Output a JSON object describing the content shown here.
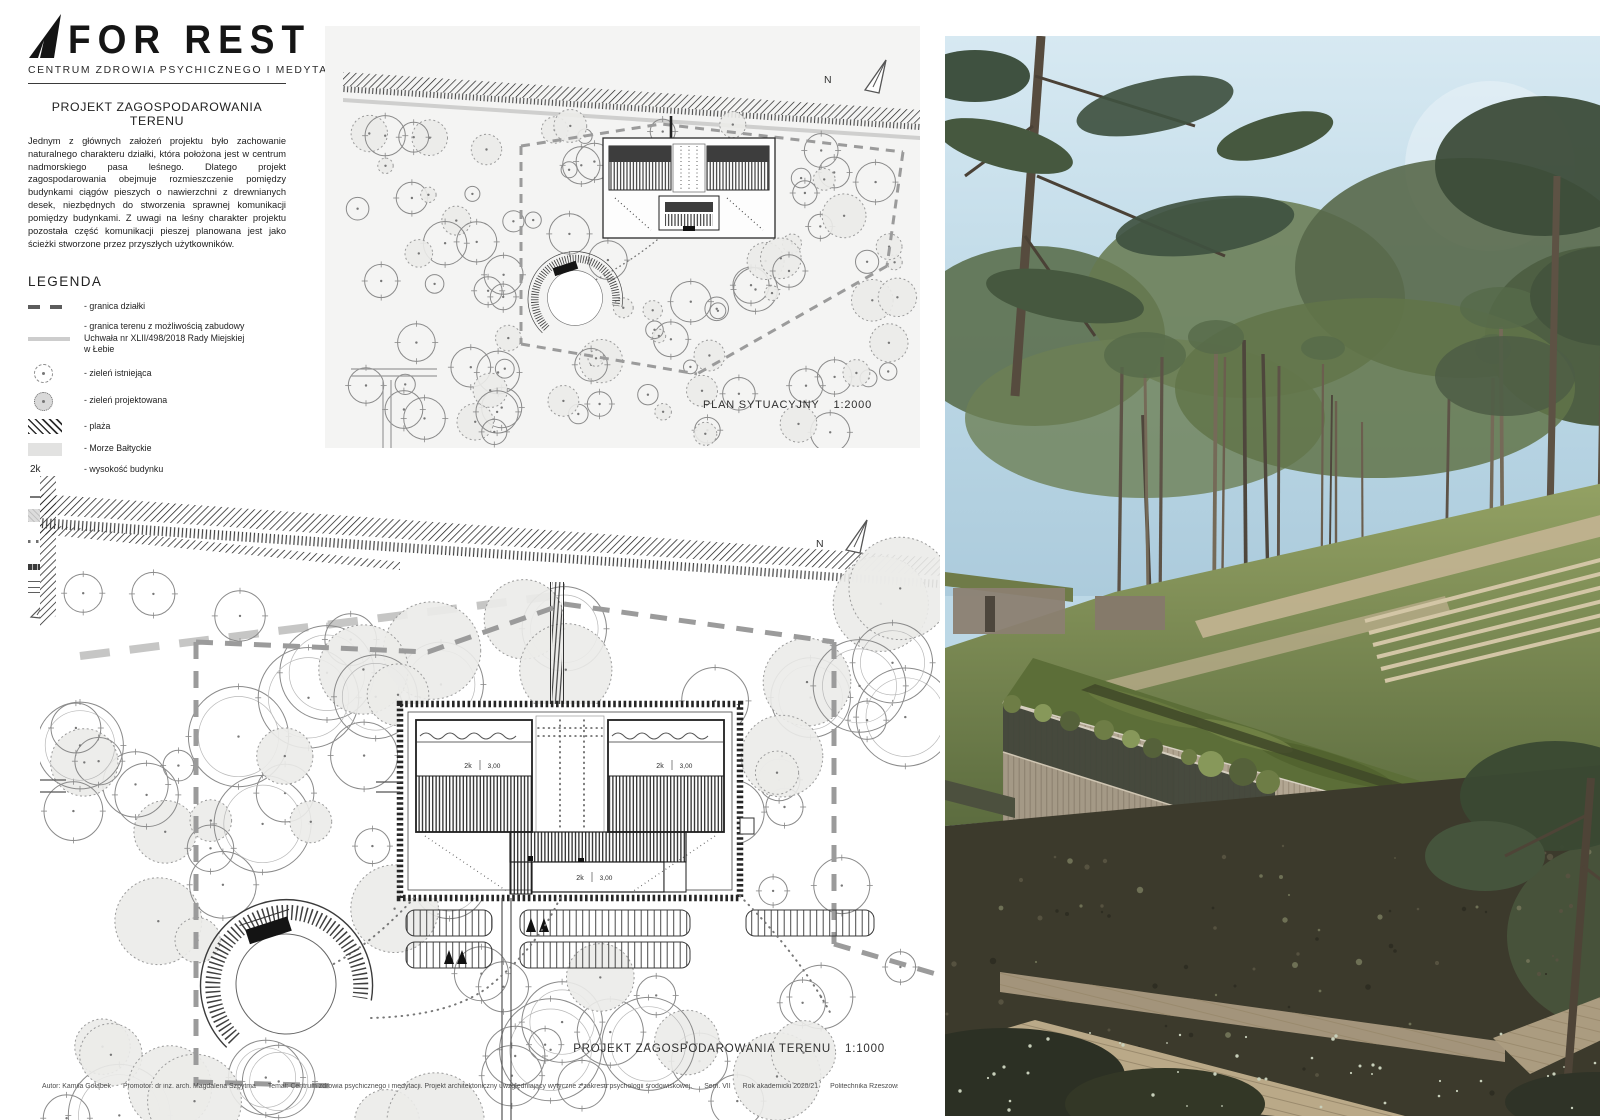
{
  "board": {
    "logo": {
      "title": "FOR REST",
      "subtitle": "CENTRUM ZDROWIA PSYCHICZNEGO I MEDYTACJI"
    },
    "intro": {
      "heading": "PROJEKT ZAGOSPODAROWANIA TERENU",
      "body": "Jednym z głównych założeń projektu było zachowanie naturalnego charakteru działki, która położona jest w centrum nadmorskiego pasa leśnego. Dlatego projekt zagospodarowania obejmuje rozmieszczenie pomiędzy budynkami ciągów pieszych o nawierzchni z drewnianych desek, niezbędnych do stworzenia sprawnej komunikacji pomiędzy budynkami. Z uwagi na leśny charakter projektu pozostała część komunikacji pieszej planowana jest jako ścieżki stworzone przez przyszłych użytkowników."
    },
    "legend": {
      "heading": "LEGENDA",
      "items": [
        {
          "symbol": "dashed-line",
          "label": "- granica działki"
        },
        {
          "symbol": "gray-line",
          "label": "- granica terenu z możliwością zabudowy\nUchwała nr XLII/498/2018 Rady Miejskiej\nw Łebie"
        },
        {
          "symbol": "dashed-circle",
          "label": "- zieleń istniejąca"
        },
        {
          "symbol": "dotted-filled-circle",
          "label": "- zieleń projektowana"
        },
        {
          "symbol": "diagonal-hatch",
          "label": "- plaża"
        },
        {
          "symbol": "gray-fill",
          "label": "- Morze Bałtyckie"
        },
        {
          "symbol": "text",
          "symbol_text": "2k",
          "label": "- wysokość budynku"
        },
        {
          "symbol": "slope-arrow",
          "label": "- spadek dachu"
        },
        {
          "symbol": "green-roof-hatch",
          "label": "- zielony dach"
        },
        {
          "symbol": "dotted-line",
          "label": "- projektowane ciągi piesze o nawierzchni\ndrewnianej"
        },
        {
          "symbol": "trodden-path",
          "label": "- wydeptane ścieżki"
        },
        {
          "symbol": "double-line",
          "label": "- droga dojazdowa asfaltowa"
        },
        {
          "symbol": "north-triangle",
          "label": "- znak północy"
        }
      ]
    },
    "plan1": {
      "caption": "PLAN SYTUACYJNY",
      "scale": "1:2000",
      "north": "N"
    },
    "plan2": {
      "caption": "PROJEKT ZAGOSPODAROWANIA TERENU",
      "scale": "1:1000",
      "north": "N",
      "building_label": "2k",
      "building_elevation": "3,00"
    },
    "footer": {
      "segments": [
        "Autor: Kamila Gołąbek",
        "Promotor: dr inż. arch. Magdalena Szpytma",
        "Temat: Centrum zdrowia psychicznego i medytacji. Projekt architektoniczny uwzględniający wytyczne z zakresu psychologii środowiskowej.",
        "Sem. VII",
        "Rok akademicki 2020/21",
        "Politechnika Rzeszowska",
        "Plansza 2"
      ]
    },
    "colors": {
      "ink": "#1d1d1d",
      "panel_gray": "#f4f4f3",
      "boundary_dash": "#9b9b9b",
      "tree_fill": "#ebebe9",
      "sky": "#bcd8e6",
      "roof_green": "#5c6e38",
      "timber": "#b2a692"
    }
  }
}
